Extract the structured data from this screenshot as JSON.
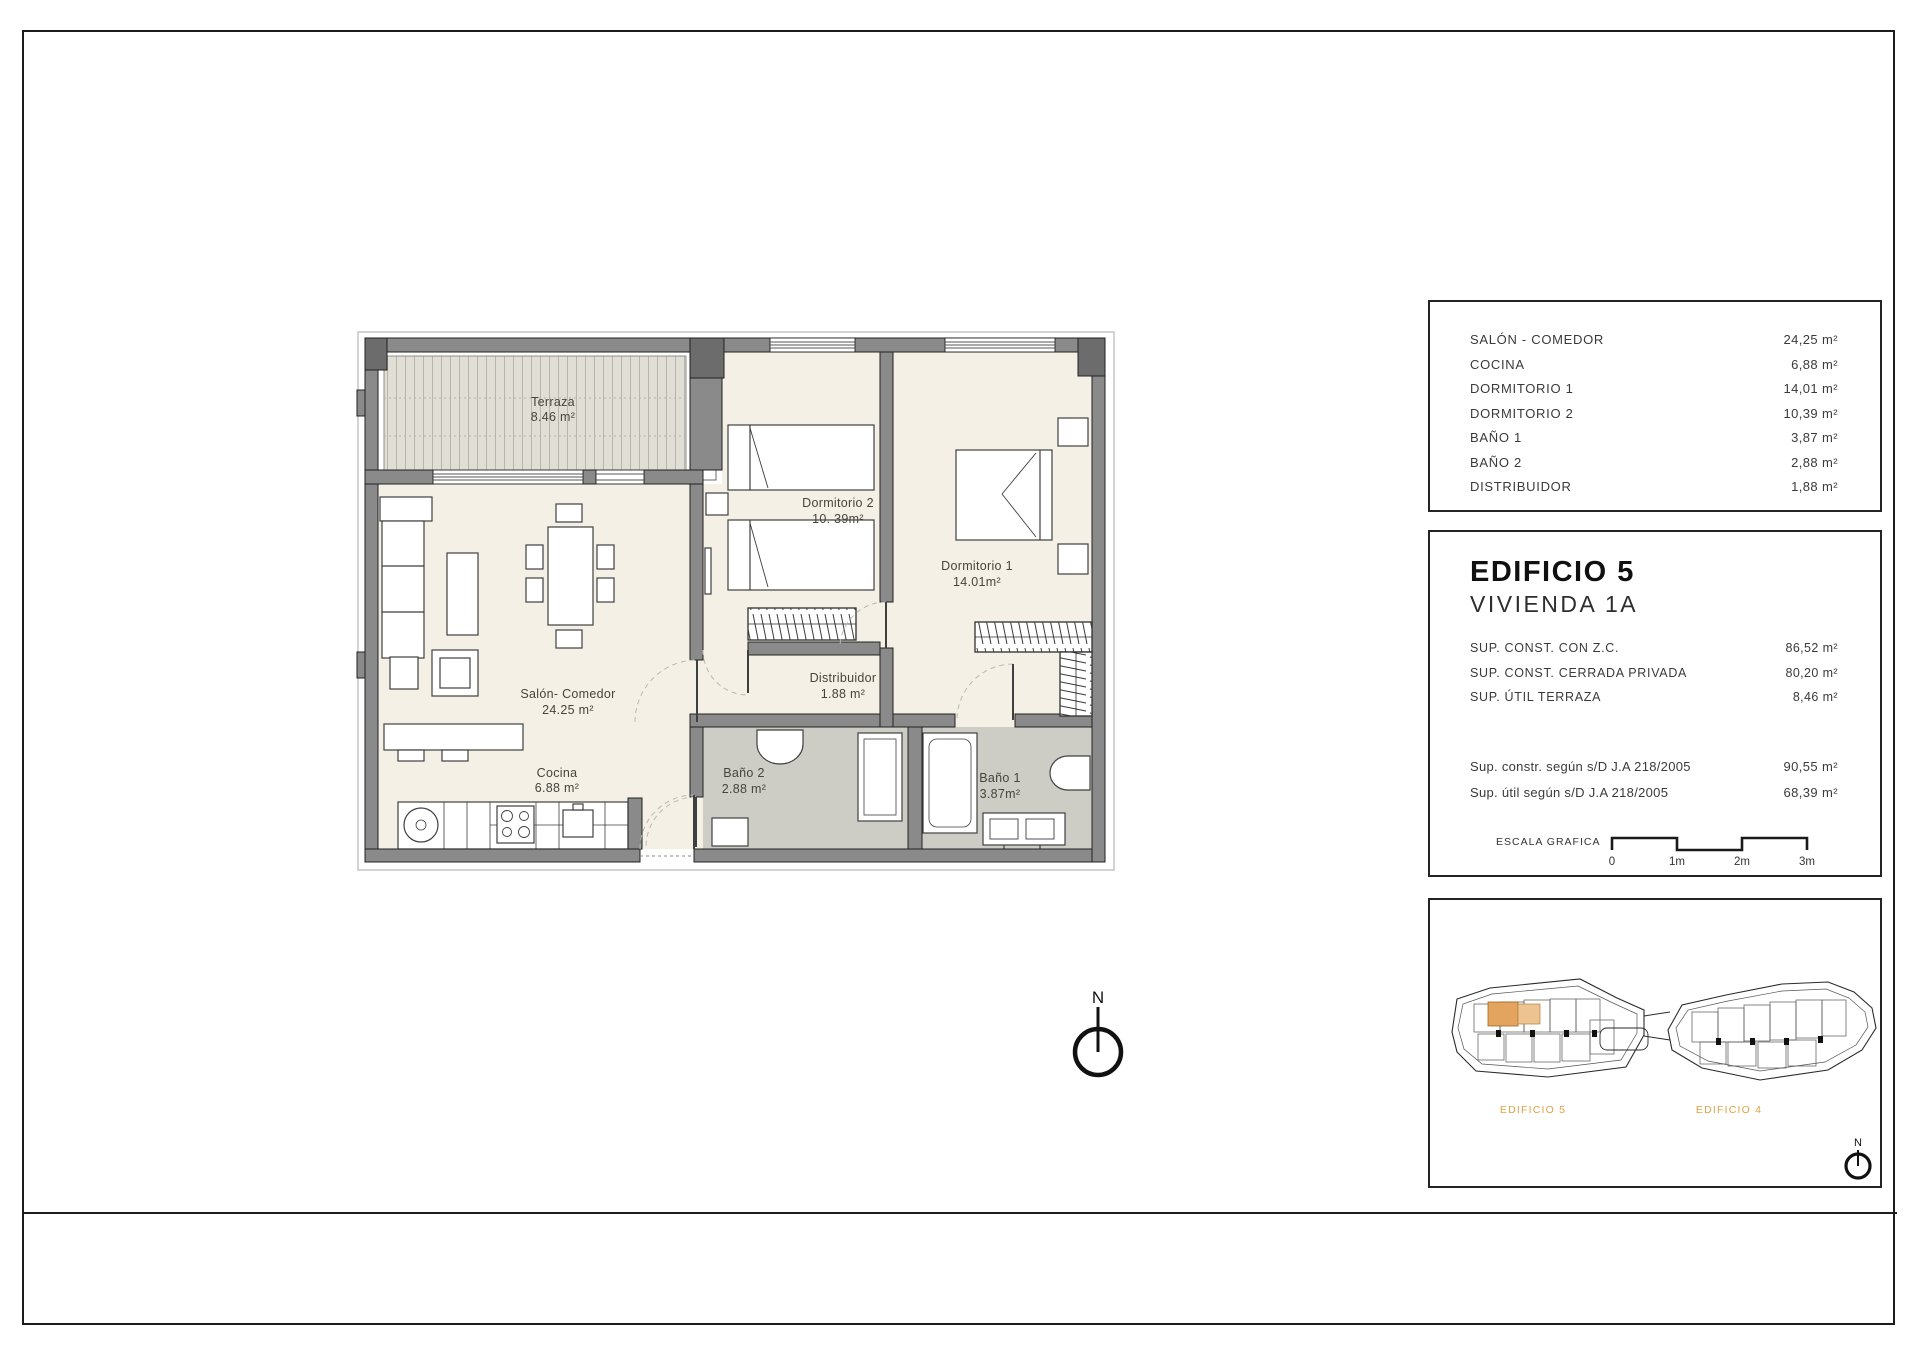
{
  "plan": {
    "rooms": [
      {
        "name": "Terraza",
        "area": "8.46 m²"
      },
      {
        "name": "Salón- Comedor",
        "area": "24.25 m²"
      },
      {
        "name": "Cocina",
        "area": "6.88 m²"
      },
      {
        "name": "Dormitorio 2",
        "area": "10. 39m²"
      },
      {
        "name": "Dormitorio 1",
        "area": "14.01m²"
      },
      {
        "name": "Distribuidor",
        "area": "1.88 m²"
      },
      {
        "name": "Baño 2",
        "area": "2.88 m²"
      },
      {
        "name": "Baño 1",
        "area": "3.87m²"
      }
    ]
  },
  "areas_panel": {
    "rows": [
      {
        "label": "SALÓN - COMEDOR",
        "value": "24,25 m²"
      },
      {
        "label": "COCINA",
        "value": "6,88 m²"
      },
      {
        "label": "DORMITORIO 1",
        "value": "14,01 m²"
      },
      {
        "label": "DORMITORIO 2",
        "value": "10,39 m²"
      },
      {
        "label": "BAÑO 1",
        "value": "3,87 m²"
      },
      {
        "label": "BAÑO 2",
        "value": "2,88 m²"
      },
      {
        "label": "DISTRIBUIDOR",
        "value": "1,88 m²"
      }
    ]
  },
  "unit_panel": {
    "building": "EDIFICIO 5",
    "unit": "VIVIENDA 1A",
    "surfaces": [
      {
        "label": "SUP. CONST. CON Z.C.",
        "value": "86,52 m²"
      },
      {
        "label": "SUP. CONST. CERRADA PRIVADA",
        "value": "80,20 m²"
      },
      {
        "label": "SUP. ÚTIL TERRAZA",
        "value": "8,46 m²"
      }
    ],
    "legal": [
      {
        "label": "Sup. constr. según s/D J.A 218/2005",
        "value": "90,55 m²"
      },
      {
        "label": "Sup. útil según s/D J.A 218/2005",
        "value": "68,39 m²"
      }
    ],
    "scale": {
      "label": "ESCALA GRAFICA",
      "ticks": [
        "0",
        "1m",
        "2m",
        "3m"
      ]
    }
  },
  "site_panel": {
    "building_labels": [
      "EDIFICIO 5",
      "EDIFICIO 4"
    ],
    "compass": "N"
  },
  "compass": {
    "label": "N"
  },
  "colors": {
    "highlight_orange": "#e2a45e",
    "label_orange": "#dfa245",
    "wall_gray": "#8a8a8a",
    "room_floor": "#f4f0e6",
    "bath_floor": "#cdcdc5",
    "terrace_floor": "#e1dfd5"
  }
}
